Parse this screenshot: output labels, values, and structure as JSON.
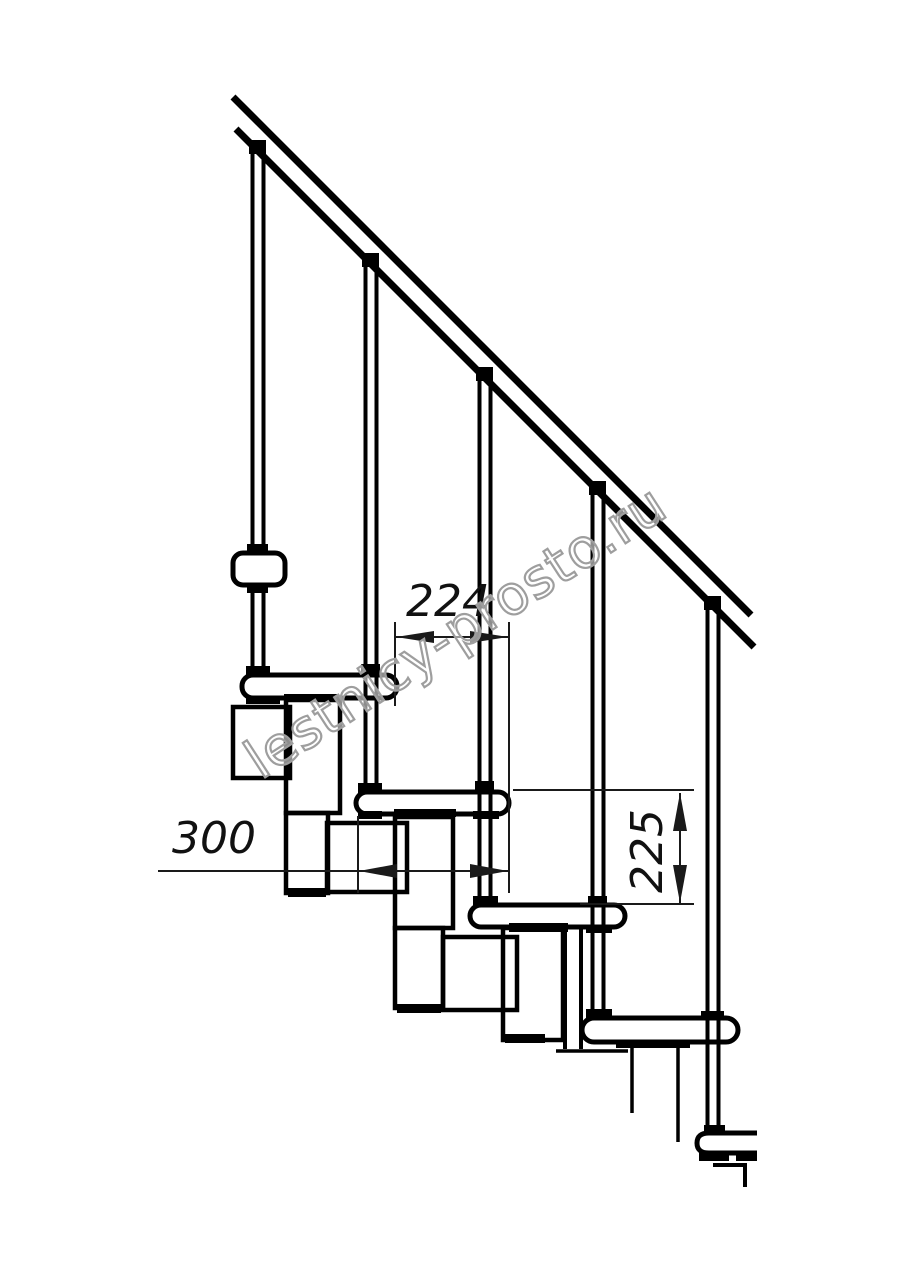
{
  "drawing": {
    "dimensions": {
      "spacing_224": "224",
      "depth_300": "300",
      "rise_225": "225"
    },
    "watermark": {
      "text": "lestnicy-prosto.ru",
      "outline_color": "#9e9e9e"
    },
    "colors": {
      "background": "#ffffff",
      "line": "#000000",
      "dimension_line": "#1a1a1a"
    },
    "elements": {
      "handrail": 1,
      "balusters": 5,
      "treads": 5,
      "spine_modules": 3
    }
  }
}
